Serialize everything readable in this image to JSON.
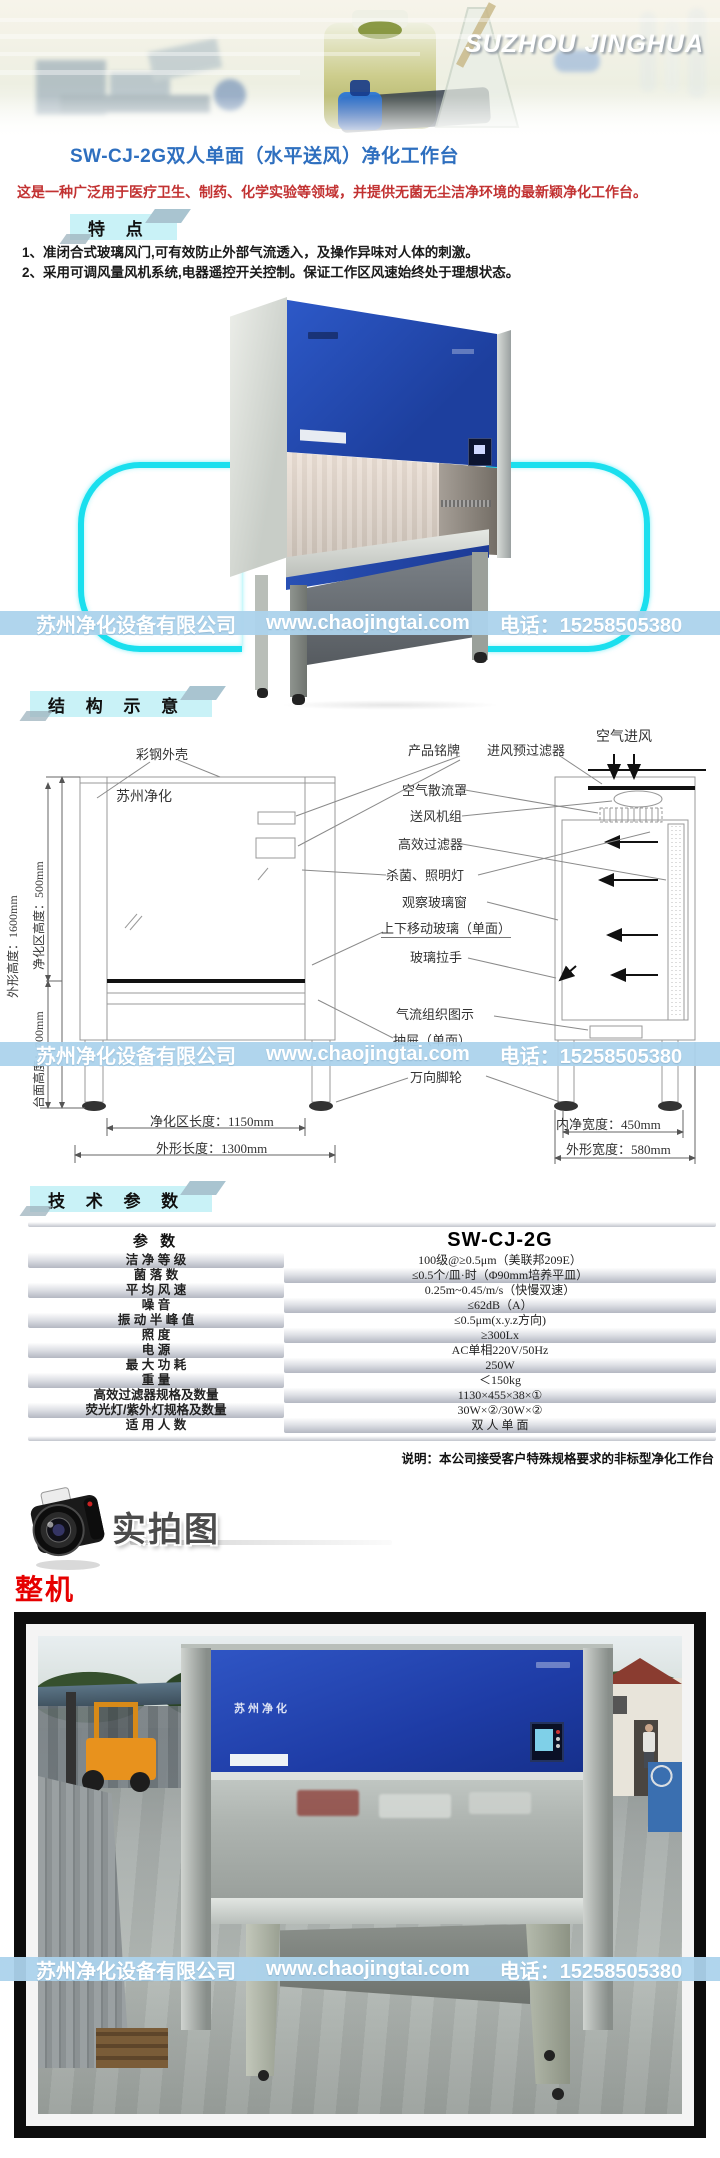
{
  "banner": {
    "brand": "SUZHOU JINGHUA"
  },
  "product": {
    "title": "SW-CJ-2G双人单面（水平送风）净化工作台",
    "description": "这是一种广泛用于医疗卫生、制药、化学实验等领域，并提供无菌无尘洁净环境的最新颖净化工作台。",
    "brand_mark": "苏州净化"
  },
  "features": {
    "heading": "特 点",
    "items": [
      "1、准闭合式玻璃风门,可有效防止外部气流透入，及操作异味对人体的刺激。",
      "2、采用可调风量风机系统,电器遥控开关控制。保证工作区风速始终处于理想状态。"
    ]
  },
  "watermark": {
    "company": "苏州净化设备有限公司",
    "website": "www.chaojingtai.com",
    "phone_label": "电话：",
    "phone_number": "15258505380"
  },
  "structure": {
    "heading": "结 构 示 意",
    "labels": {
      "shell": "彩钢外壳",
      "nameplate": "产品铭牌",
      "prefilter": "进风预过滤器",
      "air_intake": "空气进风",
      "diffuser": "空气散流罩",
      "blower": "送风机组",
      "hepa": "高效过滤器",
      "lamp": "杀菌、照明灯",
      "window": "观察玻璃窗",
      "moving_glass": "上下移动玻璃（单面）",
      "handle": "玻璃拉手",
      "airflow": "气流组织图示",
      "drawer": "抽屉（单面）",
      "caster": "万向脚轮"
    },
    "dimensions": {
      "overall_height": "外形高度：1600mm",
      "clean_height": "净化区高度：500mm",
      "table_height": "台面高度：700mm",
      "clean_length": "净化区长度：1150mm",
      "overall_length": "外形长度：1300mm",
      "inner_width": "内净宽度：450mm",
      "overall_width": "外形宽度：580mm"
    }
  },
  "specs": {
    "heading": "技 术 参 数",
    "columns": [
      "参 数",
      "SW-CJ-2G"
    ],
    "rows": [
      {
        "label": "洁 净 等 级",
        "value": "100级@≥0.5μm（美联邦209E）"
      },
      {
        "label": "菌 落 数",
        "value": "≤0.5个/皿·时（Φ90mm培养平皿）"
      },
      {
        "label": "平 均 风 速",
        "value": "0.25m~0.45/m/s（快慢双速）"
      },
      {
        "label": "噪 音",
        "value": "≤62dB（A）"
      },
      {
        "label": "振 动 半 峰 值",
        "value": "≤0.5μm(x.y.z方向)"
      },
      {
        "label": "照 度",
        "value": "≥300Lx"
      },
      {
        "label": "电 源",
        "value": "AC单相220V/50Hz"
      },
      {
        "label": "最 大 功 耗",
        "value": "250W"
      },
      {
        "label": "重 量",
        "value": "＜150kg"
      },
      {
        "label": "高效过滤器规格及数量",
        "value": "1130×455×38×①"
      },
      {
        "label": "荧光灯/紫外灯规格及数量",
        "value": "30W×②/30W×②"
      },
      {
        "label": "适 用 人 数",
        "value": "双 人 单 面"
      }
    ],
    "note": "说明：本公司接受客户特殊规格要求的非标型净化工作台"
  },
  "photos": {
    "heading": "实拍图",
    "sub_label": "整机"
  }
}
